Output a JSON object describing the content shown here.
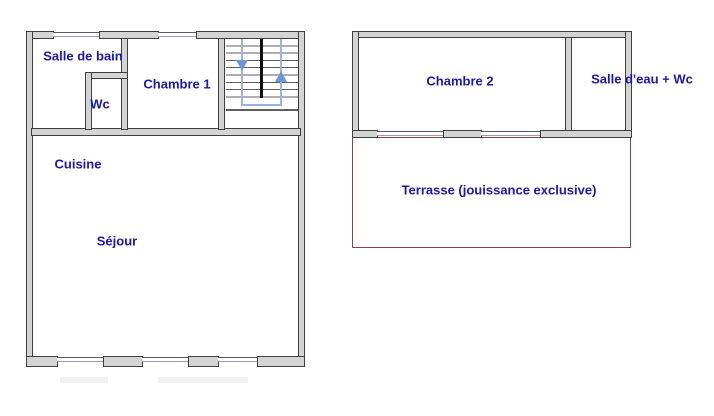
{
  "document": {
    "type": "floor-plan",
    "units": 2
  },
  "colors": {
    "background": "#ffffff",
    "wall_fill": "#d4d4d4",
    "wall_line": "#3f3f3f",
    "label_text": "#1a18b4",
    "window_line_dark": "#55557e",
    "window_line_light": "#9a9aae",
    "step_line": "#5f5f5f",
    "stair_divider": "#111111",
    "stair_path": "#9ab5e2",
    "stair_arrow": "#6d96d8",
    "terrace_border": "#8c4343",
    "shadow": "#ececec"
  },
  "left_unit": {
    "rooms": [
      {
        "key": "salle_de_bain",
        "label": "Salle de bain"
      },
      {
        "key": "wc",
        "label": "Wc"
      },
      {
        "key": "chambre_1",
        "label": "Chambre 1"
      },
      {
        "key": "cuisine",
        "label": "Cuisine"
      },
      {
        "key": "sejour",
        "label": "Séjour"
      }
    ],
    "features": [
      {
        "key": "staircase",
        "description": "double-flight staircase with down and up arrows"
      }
    ]
  },
  "right_unit": {
    "rooms": [
      {
        "key": "chambre_2",
        "label": "Chambre 2"
      },
      {
        "key": "salle_deau_wc",
        "label": "Salle d'eau + Wc"
      },
      {
        "key": "terrasse",
        "label": "Terrasse (jouissance exclusive)"
      }
    ]
  }
}
